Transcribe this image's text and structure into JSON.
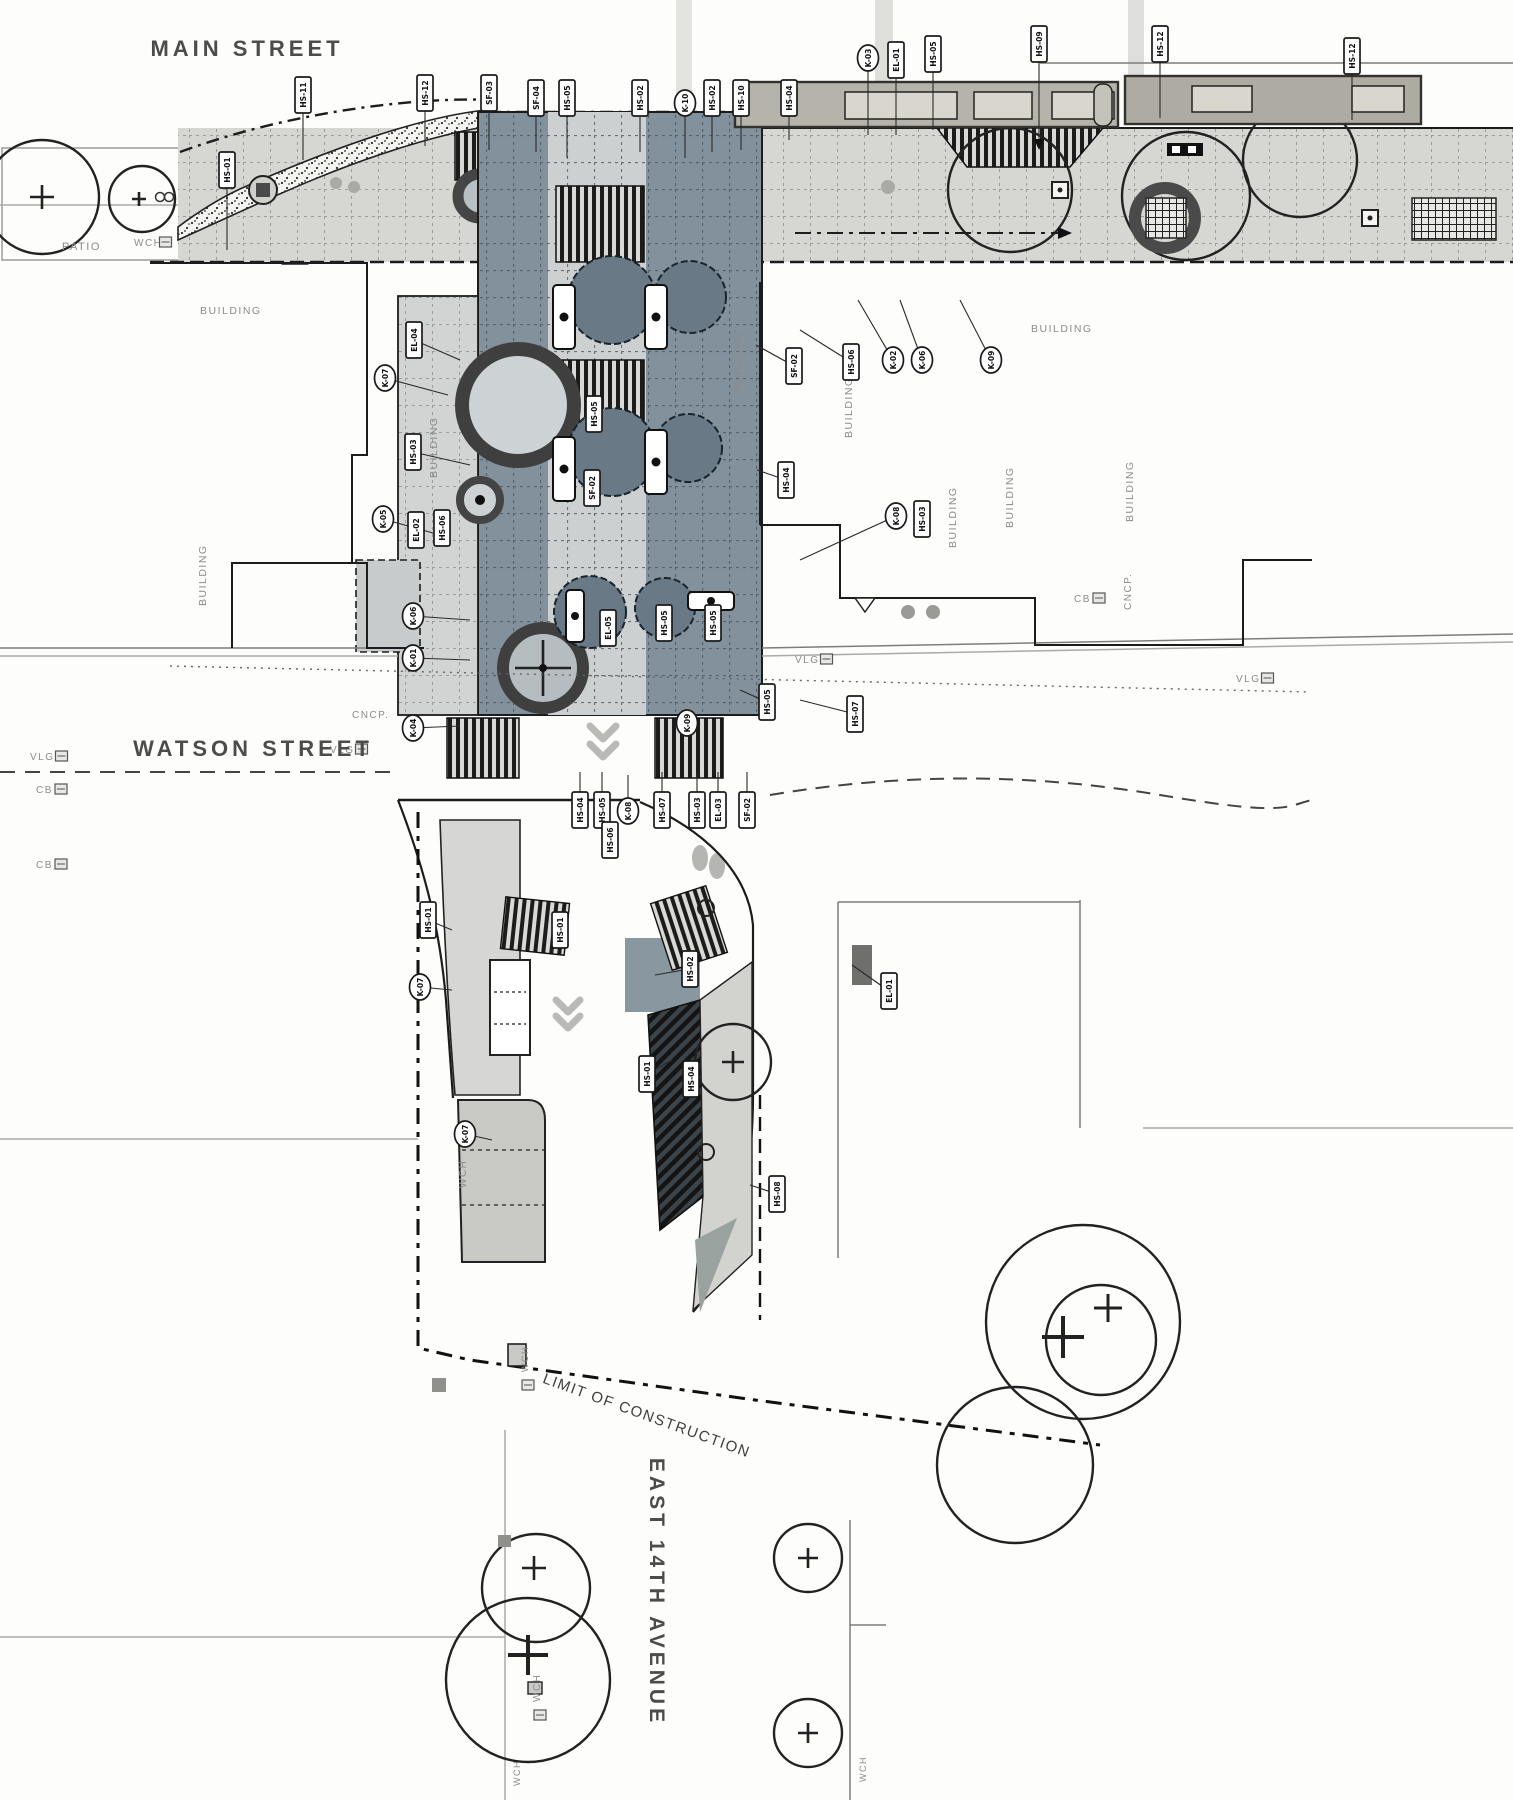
{
  "plan": {
    "type": "landscape-construction-site-plan",
    "streets": {
      "main_street": "MAIN STREET",
      "watson_street": "WATSON STREET",
      "east_14th_avenue": "EAST 14TH AVENUE",
      "limit_of_construction": "LIMIT OF CONSTRUCTION"
    },
    "colors": {
      "paper": "#fdfdfc",
      "sidewalk": "#d6d6d2",
      "plaza": "#82919b",
      "plaza_walk": "#ccd0d1",
      "canopy": "#b6b3ab",
      "skylight": "#d9d6cd",
      "line": "#1c1c1c",
      "label_gray": "#8b8b88"
    },
    "area_labels": [
      {
        "text": "PATIO",
        "x": 62,
        "y": 250,
        "rot": 0,
        "size": 11
      },
      {
        "text": "WCH",
        "x": 134,
        "y": 246,
        "rot": 0,
        "size": 10,
        "box": true
      },
      {
        "text": "BUILDING",
        "x": 200,
        "y": 314,
        "rot": 0,
        "size": 10.5
      },
      {
        "text": "BUILDING",
        "x": 437,
        "y": 478,
        "rot": -90,
        "size": 10.5
      },
      {
        "text": "BUILDING",
        "x": 741,
        "y": 392,
        "rot": -90,
        "size": 10.5
      },
      {
        "text": "BUILDING",
        "x": 1031,
        "y": 332,
        "rot": 0,
        "size": 10.5
      },
      {
        "text": "BUILDING",
        "x": 852,
        "y": 438,
        "rot": -90,
        "size": 10.5
      },
      {
        "text": "BUILDING",
        "x": 956,
        "y": 548,
        "rot": -90,
        "size": 10.5
      },
      {
        "text": "BUILDING",
        "x": 1013,
        "y": 528,
        "rot": -90,
        "size": 10.5
      },
      {
        "text": "BUILDING",
        "x": 1133,
        "y": 522,
        "rot": -90,
        "size": 10.5
      },
      {
        "text": "BUILDING",
        "x": 206,
        "y": 606,
        "rot": -90,
        "size": 10.5
      },
      {
        "text": "CNCP.",
        "x": 352,
        "y": 718,
        "rot": 0,
        "size": 10
      },
      {
        "text": "CNCP.",
        "x": 1131,
        "y": 610,
        "rot": -90,
        "size": 10
      },
      {
        "text": "VLG",
        "x": 30,
        "y": 760,
        "rot": 0,
        "size": 10,
        "box": true
      },
      {
        "text": "VLG",
        "x": 330,
        "y": 753,
        "rot": 0,
        "size": 10,
        "box": true
      },
      {
        "text": "VLG",
        "x": 795,
        "y": 663,
        "rot": 0,
        "size": 10,
        "box": true
      },
      {
        "text": "VLG",
        "x": 1236,
        "y": 682,
        "rot": 0,
        "size": 10,
        "box": true
      },
      {
        "text": "CB",
        "x": 36,
        "y": 793,
        "rot": 0,
        "size": 10,
        "box": true
      },
      {
        "text": "CB",
        "x": 36,
        "y": 868,
        "rot": 0,
        "size": 10,
        "box": true
      },
      {
        "text": "CB",
        "x": 1074,
        "y": 602,
        "rot": 0,
        "size": 10,
        "box": true
      },
      {
        "text": "WCH",
        "x": 466,
        "y": 1188,
        "rot": -90,
        "size": 10
      },
      {
        "text": "WCH",
        "x": 528,
        "y": 1372,
        "rot": -90,
        "size": 9,
        "box": true
      },
      {
        "text": "WCH",
        "x": 540,
        "y": 1702,
        "rot": -90,
        "size": 10,
        "box": true
      },
      {
        "text": "WCH",
        "x": 520,
        "y": 1786,
        "rot": -90,
        "size": 9
      },
      {
        "text": "WCH",
        "x": 866,
        "y": 1782,
        "rot": -90,
        "size": 9
      }
    ],
    "callouts": [
      {
        "code": "HS-01",
        "x": 227,
        "y": 170,
        "s": "r",
        "lx": 227,
        "ly": 250
      },
      {
        "code": "HS-11",
        "x": 303,
        "y": 95,
        "s": "r",
        "lx": 303,
        "ly": 160
      },
      {
        "code": "HS-12",
        "x": 425,
        "y": 93,
        "s": "r",
        "lx": 425,
        "ly": 146
      },
      {
        "code": "SF-03",
        "x": 489,
        "y": 93,
        "s": "r",
        "lx": 489,
        "ly": 150
      },
      {
        "code": "SF-04",
        "x": 536,
        "y": 98,
        "s": "r",
        "lx": 536,
        "ly": 152
      },
      {
        "code": "HS-05",
        "x": 567,
        "y": 98,
        "s": "r",
        "lx": 567,
        "ly": 158
      },
      {
        "code": "HS-02",
        "x": 640,
        "y": 98,
        "s": "r",
        "lx": 640,
        "ly": 152
      },
      {
        "code": "K-10",
        "x": 685,
        "y": 103,
        "s": "c",
        "lx": 685,
        "ly": 158
      },
      {
        "code": "HS-02",
        "x": 712,
        "y": 98,
        "s": "r",
        "lx": 712,
        "ly": 152
      },
      {
        "code": "HS-10",
        "x": 741,
        "y": 98,
        "s": "r",
        "lx": 741,
        "ly": 150
      },
      {
        "code": "HS-04",
        "x": 789,
        "y": 98,
        "s": "r",
        "lx": 789,
        "ly": 140
      },
      {
        "code": "K-03",
        "x": 868,
        "y": 58,
        "s": "c",
        "lx": 868,
        "ly": 135
      },
      {
        "code": "EL-01",
        "x": 896,
        "y": 60,
        "s": "r",
        "lx": 896,
        "ly": 135
      },
      {
        "code": "HS-05",
        "x": 933,
        "y": 54,
        "s": "r",
        "lx": 933,
        "ly": 130
      },
      {
        "code": "HS-09",
        "x": 1039,
        "y": 44,
        "s": "r",
        "lx": 1039,
        "ly": 148,
        "arrow": true
      },
      {
        "code": "HS-12",
        "x": 1160,
        "y": 44,
        "s": "r",
        "lx": 1160,
        "ly": 118
      },
      {
        "code": "HS-12",
        "x": 1352,
        "y": 56,
        "s": "r",
        "lx": 1352,
        "ly": 120
      },
      {
        "code": "K-07",
        "x": 385,
        "y": 378,
        "s": "c",
        "lx": 448,
        "ly": 395
      },
      {
        "code": "EL-04",
        "x": 414,
        "y": 340,
        "s": "r",
        "lx": 460,
        "ly": 360
      },
      {
        "code": "HS-03",
        "x": 413,
        "y": 452,
        "s": "r",
        "lx": 470,
        "ly": 465
      },
      {
        "code": "K-05",
        "x": 383,
        "y": 519,
        "s": "c",
        "lx": 440,
        "ly": 535
      },
      {
        "code": "EL-02",
        "x": 416,
        "y": 530,
        "s": "r"
      },
      {
        "code": "HS-06",
        "x": 442,
        "y": 528,
        "s": "r"
      },
      {
        "code": "HS-05",
        "x": 594,
        "y": 414,
        "s": "r"
      },
      {
        "code": "SF-02",
        "x": 592,
        "y": 488,
        "s": "r"
      },
      {
        "code": "SF-02",
        "x": 794,
        "y": 366,
        "s": "r",
        "lx": 756,
        "ly": 345
      },
      {
        "code": "HS-06",
        "x": 851,
        "y": 362,
        "s": "r",
        "lx": 800,
        "ly": 330
      },
      {
        "code": "K-02",
        "x": 893,
        "y": 360,
        "s": "c",
        "lx": 858,
        "ly": 300
      },
      {
        "code": "K-06",
        "x": 922,
        "y": 360,
        "s": "c",
        "lx": 900,
        "ly": 300
      },
      {
        "code": "K-09",
        "x": 991,
        "y": 360,
        "s": "c",
        "lx": 960,
        "ly": 300
      },
      {
        "code": "HS-04",
        "x": 786,
        "y": 480,
        "s": "r",
        "lx": 757,
        "ly": 470
      },
      {
        "code": "K-08",
        "x": 896,
        "y": 516,
        "s": "c",
        "lx": 800,
        "ly": 560
      },
      {
        "code": "HS-03",
        "x": 922,
        "y": 519,
        "s": "r"
      },
      {
        "code": "K-06",
        "x": 413,
        "y": 616,
        "s": "c",
        "lx": 470,
        "ly": 620
      },
      {
        "code": "K-01",
        "x": 413,
        "y": 658,
        "s": "c",
        "lx": 470,
        "ly": 660
      },
      {
        "code": "K-04",
        "x": 413,
        "y": 728,
        "s": "c",
        "lx": 460,
        "ly": 726
      },
      {
        "code": "EL-05",
        "x": 608,
        "y": 628,
        "s": "r"
      },
      {
        "code": "HS-05",
        "x": 664,
        "y": 623,
        "s": "r"
      },
      {
        "code": "HS-05",
        "x": 713,
        "y": 623,
        "s": "r"
      },
      {
        "code": "HS-05",
        "x": 767,
        "y": 702,
        "s": "r",
        "lx": 740,
        "ly": 690
      },
      {
        "code": "HS-07",
        "x": 855,
        "y": 714,
        "s": "r",
        "lx": 800,
        "ly": 700
      },
      {
        "code": "K-09",
        "x": 687,
        "y": 723,
        "s": "c"
      },
      {
        "code": "HS-04",
        "x": 580,
        "y": 810,
        "s": "r",
        "lx": 580,
        "ly": 772
      },
      {
        "code": "HS-05",
        "x": 602,
        "y": 810,
        "s": "r",
        "lx": 602,
        "ly": 772
      },
      {
        "code": "K-08",
        "x": 628,
        "y": 811,
        "s": "c",
        "lx": 628,
        "ly": 775
      },
      {
        "code": "HS-07",
        "x": 662,
        "y": 810,
        "s": "r",
        "lx": 662,
        "ly": 772
      },
      {
        "code": "HS-03",
        "x": 697,
        "y": 810,
        "s": "r",
        "lx": 697,
        "ly": 772
      },
      {
        "code": "EL-03",
        "x": 718,
        "y": 810,
        "s": "r",
        "lx": 718,
        "ly": 772
      },
      {
        "code": "SF-02",
        "x": 747,
        "y": 810,
        "s": "r",
        "lx": 747,
        "ly": 772
      },
      {
        "code": "HS-06",
        "x": 610,
        "y": 840,
        "s": "r"
      },
      {
        "code": "HS-01",
        "x": 428,
        "y": 920,
        "s": "r",
        "lx": 452,
        "ly": 930
      },
      {
        "code": "K-07",
        "x": 420,
        "y": 987,
        "s": "c",
        "lx": 452,
        "ly": 990
      },
      {
        "code": "HS-01",
        "x": 560,
        "y": 930,
        "s": "r"
      },
      {
        "code": "HS-02",
        "x": 690,
        "y": 969,
        "s": "r",
        "lx": 655,
        "ly": 975
      },
      {
        "code": "EL-01",
        "x": 889,
        "y": 991,
        "s": "r",
        "lx": 852,
        "ly": 965
      },
      {
        "code": "HS-01",
        "x": 647,
        "y": 1074,
        "s": "r",
        "lx": 672,
        "ly": 1060
      },
      {
        "code": "HS-04",
        "x": 691,
        "y": 1079,
        "s": "r"
      },
      {
        "code": "K-07",
        "x": 465,
        "y": 1134,
        "s": "c",
        "lx": 492,
        "ly": 1140
      },
      {
        "code": "HS-08",
        "x": 777,
        "y": 1194,
        "s": "r",
        "lx": 750,
        "ly": 1185
      }
    ]
  }
}
